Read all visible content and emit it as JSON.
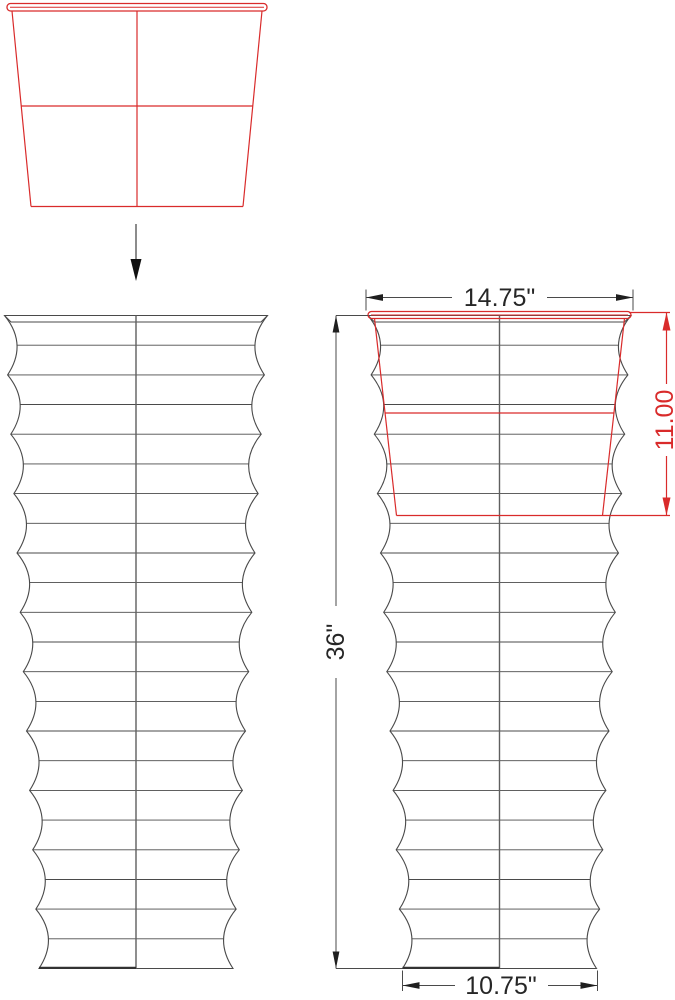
{
  "page": {
    "background": "#ffffff",
    "description": "Technical dimension drawing of a tall ribbed planter with a drop-in insert pot"
  },
  "colors": {
    "line": "#4a4a4a",
    "center_line": "#5f5f5f",
    "accent_red": "#d92b2b",
    "text": "#262626",
    "arrow": "#1f1f1f",
    "flow_arrow_shaft": "#8c8c8c",
    "flow_arrow_head": "#111111",
    "bottom_edge": "#333333",
    "background": "#ffffff"
  },
  "views": {
    "insert_top": {
      "name": "insert-pot-outline"
    },
    "front": {
      "name": "ribbed-planter-front-view"
    },
    "dimensioned": {
      "name": "ribbed-planter-dimensioned-view-with-insert"
    }
  },
  "dimensions": {
    "top_width": {
      "label": "14.75\"",
      "inches": 14.75
    },
    "insert_depth": {
      "label": "11.00",
      "inches": 11.0
    },
    "height": {
      "label": "36\"",
      "inches": 36.0
    },
    "bottom_width": {
      "label": "10.75\"",
      "inches": 10.75
    }
  }
}
